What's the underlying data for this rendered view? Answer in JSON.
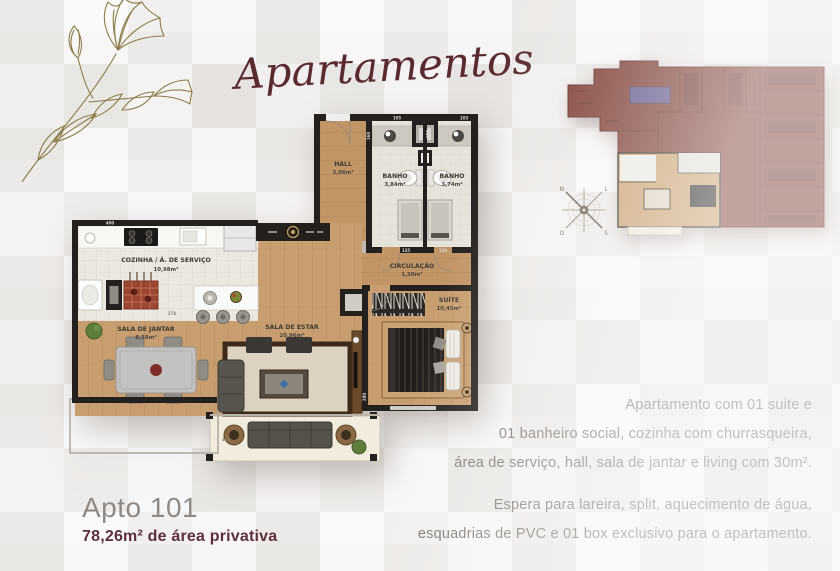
{
  "header": {
    "title": "Apartamentos"
  },
  "compass": {
    "n": "N",
    "l": "L",
    "s": "S",
    "o": "O"
  },
  "floorplan": {
    "rooms": {
      "hall": {
        "name": "HALL",
        "area": "3,06m²"
      },
      "banho1": {
        "name": "BANHO",
        "area": "3,84m²"
      },
      "banho2": {
        "name": "BANHO",
        "area": "3,74m²"
      },
      "circulacao": {
        "name": "CIRCULAÇÃO",
        "area": "1,50m²"
      },
      "suite": {
        "name": "SUÍTE",
        "area": "10,45m²"
      },
      "cozinha": {
        "name": "COZINHA / Á. DE SERVIÇO",
        "area": "10,98m²"
      },
      "jantar": {
        "name": "SALA DE JANTAR",
        "area": "8,58m²"
      },
      "estar": {
        "name": "SALA DE ESTAR",
        "area": "20,96m²"
      }
    },
    "dimensions": {
      "d400": "400",
      "d274": "274",
      "d160": "160",
      "d105": "105",
      "d115": "115",
      "d103": "103",
      "d135": "135",
      "d130": "130",
      "d280": "280",
      "d410": "410"
    }
  },
  "footer": {
    "apto": "Apto 101",
    "area": "78,26m² de área privativa"
  },
  "description": {
    "para1": "Apartamento com  01 suite e\n01 banheiro social, cozinha com churrasqueira,\nárea de serviço, hall, sala de jantar e living com 30m².",
    "para2": "Espera para lareira, split, aquecimento de água,\nesquadrias de PVC e 01 box exclusivo para o apartamento."
  },
  "colors": {
    "accent_maroon": "#5a2a31",
    "keyplan_maroon": "#7b3a31",
    "text_gray": "#7d7772",
    "wood": "#c89e70"
  }
}
